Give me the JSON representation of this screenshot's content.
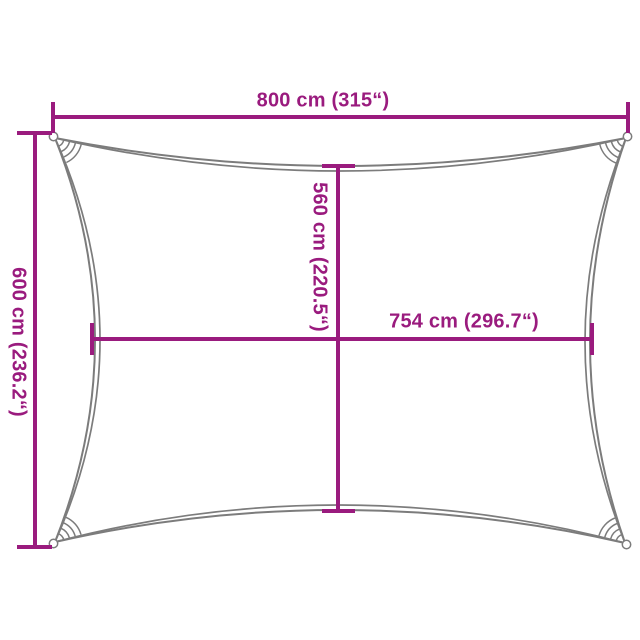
{
  "colors": {
    "accent": "#9A1B7E",
    "outline": "#7C7C7C",
    "background": "#FFFFFF"
  },
  "dimensions": {
    "width": {
      "label": "800 cm (315“)"
    },
    "height": {
      "label": "600 cm (236.2“)"
    },
    "inner_height": {
      "label": "560 cm (220.5“)"
    },
    "inner_width": {
      "label": "754 cm (296.7“)"
    }
  }
}
